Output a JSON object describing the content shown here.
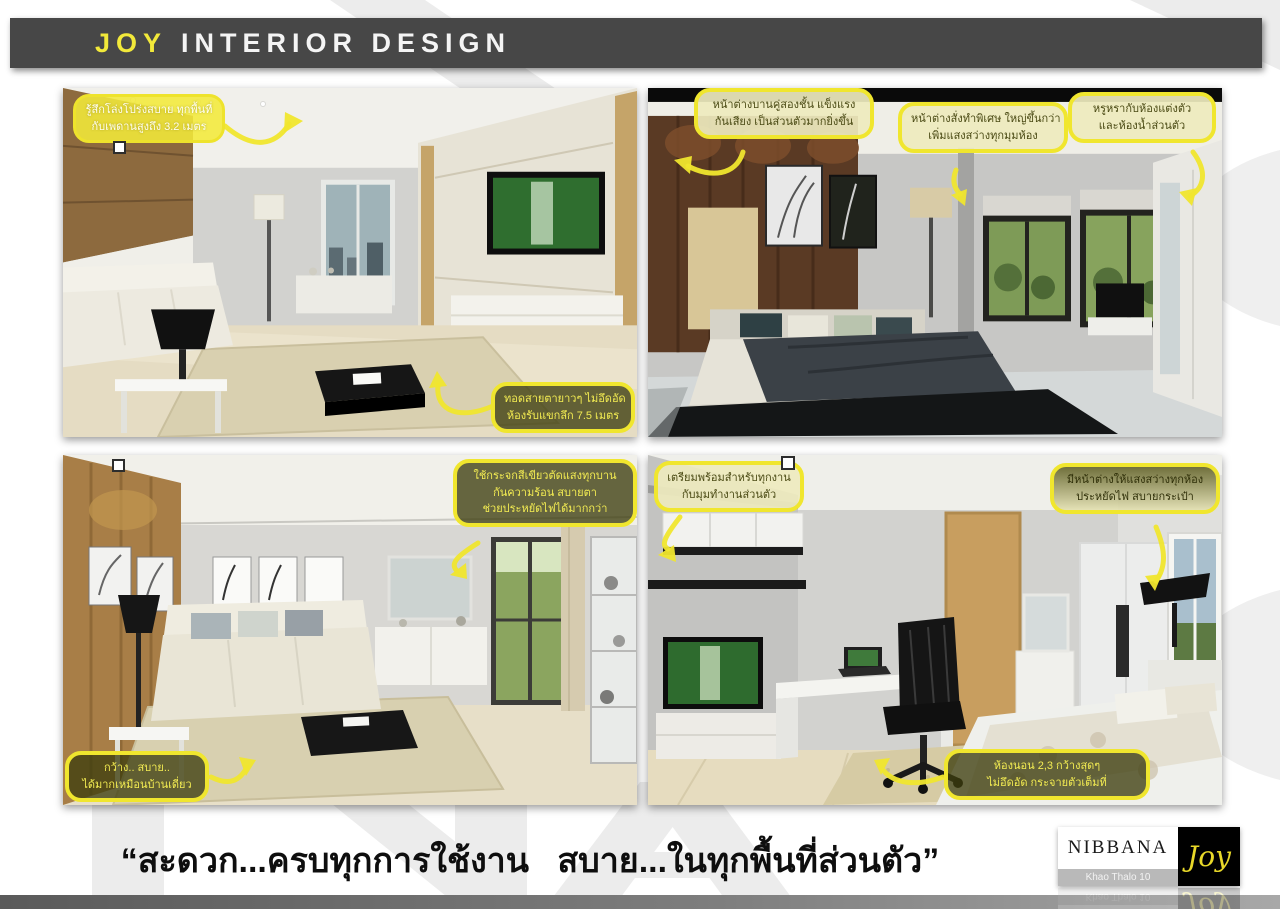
{
  "header": {
    "brand": "JOY",
    "title": "INTERIOR DESIGN"
  },
  "panels": [
    {
      "name": "living-room-hall",
      "annotations": [
        {
          "lines": [
            "รู้สึกโล่งโปร่งสบาย ทุกพื้นที่",
            "กับเพดานสูงถึง 3.2 เมตร"
          ]
        },
        {
          "lines": [
            "ทอดสายตายาวๆ ไม่อึดอัด",
            "ห้องรับแขกลึก 7.5 เมตร"
          ]
        }
      ]
    },
    {
      "name": "master-bedroom",
      "annotations": [
        {
          "lines": [
            "หน้าต่างบานคู่สองชั้น แข็งแรง",
            "กันเสียง เป็นส่วนตัวมากยิ่งขึ้น"
          ]
        },
        {
          "lines": [
            "หน้าต่างสั่งทำพิเศษ ใหญ่ขึ้นกว่า",
            "เพิ่มแสงสว่างทุกมุมห้อง"
          ]
        },
        {
          "lines": [
            "หรูหรากับห้องแต่งตัว",
            "และห้องน้ำส่วนตัว"
          ]
        }
      ]
    },
    {
      "name": "living-room-sofa",
      "annotations": [
        {
          "lines": [
            "ใช้กระจกสีเขียวตัดแสงทุกบาน",
            "กันความร้อน สบายตา",
            "ช่วยประหยัดไฟได้มากกว่า"
          ]
        },
        {
          "lines": [
            "กว้าง.. สบาย..",
            "ได้มากเหมือนบ้านเดี่ยว"
          ]
        }
      ]
    },
    {
      "name": "bedroom-workspace",
      "annotations": [
        {
          "lines": [
            "เตรียมพร้อมสำหรับทุกงาน",
            "กับมุมทำงานส่วนตัว"
          ]
        },
        {
          "lines": [
            "มีหน้าต่างให้แสงสว่างทุกห้อง",
            "ประหยัดไฟ สบายกระเป๋า"
          ]
        },
        {
          "lines": [
            "ห้องนอน 2,3 กว้างสุดๆ",
            "ไม่อึดอัด กระจายตัวเต็มที่"
          ]
        }
      ]
    }
  ],
  "tagline": "“สะดวก...ครบทุกการใช้งาน   สบาย...ในทุกพื้นที่ส่วนตัว”",
  "logo": {
    "name": "NIBBANA",
    "project": "Khao Thalo 10",
    "script": "Joy"
  },
  "colors": {
    "accent_yellow": "#f2e93a",
    "header_bg": "#474747",
    "annotation_dark": "#3e3e0e",
    "annotation_pale": "#eeeabe",
    "logo_script_yellow": "#e8d829"
  }
}
